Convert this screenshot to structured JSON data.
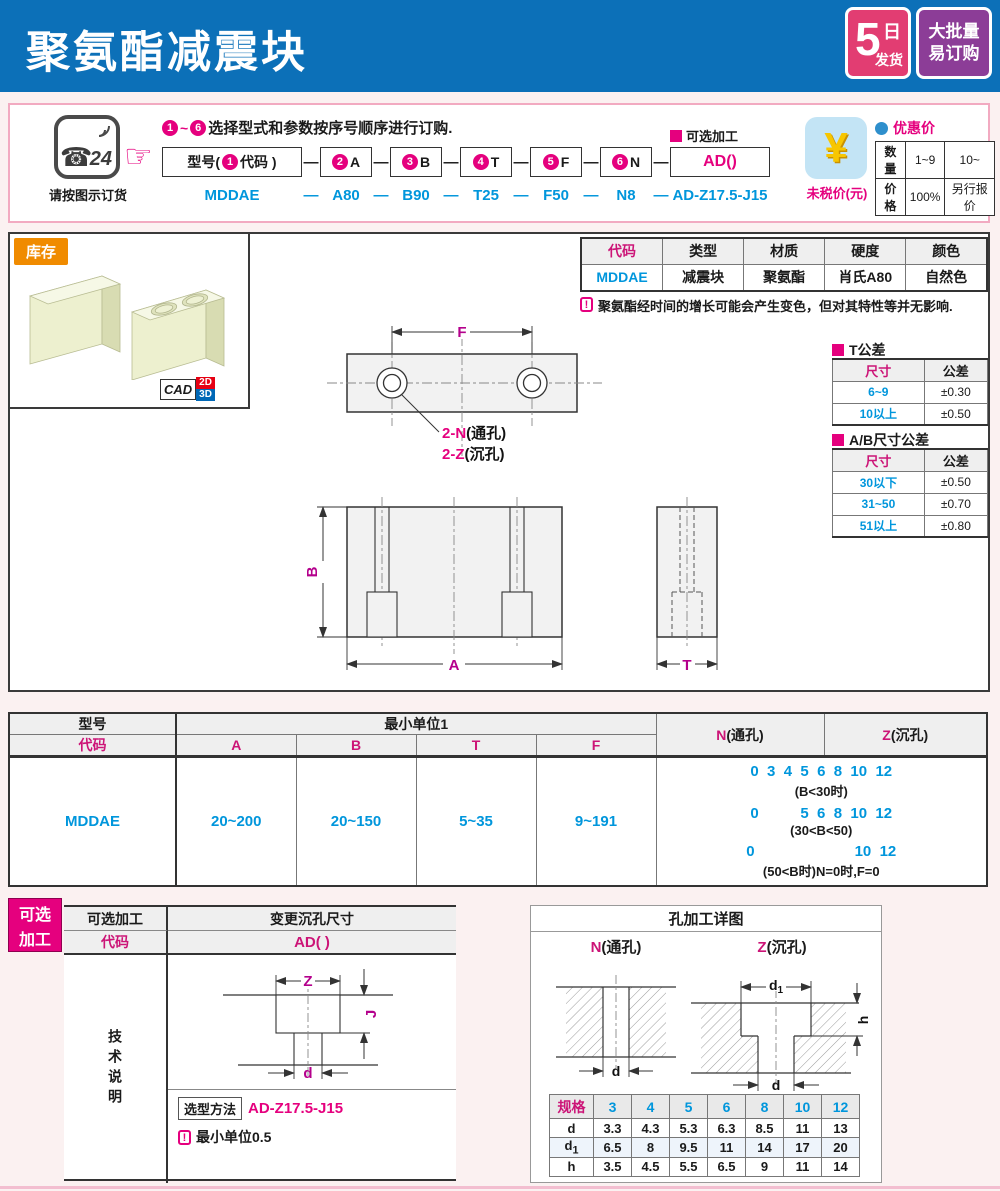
{
  "colors": {
    "header_blue": "#0c70b8",
    "accent_pink": "#e5007e",
    "data_blue": "#0096dc",
    "dim_magenta": "#b4008c",
    "stock_orange": "#f08b00",
    "badge_pink": "#e23d72",
    "badge_purple": "#8c3d97"
  },
  "chars": {
    "dash": "—",
    "tilde": "~"
  },
  "header": {
    "title": "聚氨酯减震块",
    "badge_days": {
      "num": "5",
      "unit": "日",
      "text": "发货"
    },
    "badge_bulk": {
      "line1": "大批量",
      "line2": "易订购"
    }
  },
  "order": {
    "phone": {
      "num": "24",
      "caption": "请按图示订货"
    },
    "instruction": {
      "start": "1",
      "end": "6",
      "text": "选择型式和参数按序号顺序进行订购."
    },
    "model_box": {
      "prefix": "型号(",
      "num": "1",
      "suffix": "代码 )"
    },
    "param_boxes": [
      {
        "num": "2",
        "label": "A"
      },
      {
        "num": "3",
        "label": "B"
      },
      {
        "num": "4",
        "label": "T"
      },
      {
        "num": "5",
        "label": "F"
      },
      {
        "num": "6",
        "label": "N"
      }
    ],
    "optional_label": "可选加工",
    "optional_box": "AD()",
    "example": {
      "model": "MDDAE",
      "a": "A80",
      "b": "B90",
      "t": "T25",
      "f": "F50",
      "n": "N8",
      "ad": "AD-Z17.5-J15"
    },
    "price": {
      "symbol": "¥",
      "untaxed": "未税价(元)",
      "discount": "优惠价",
      "qty_label": "数量",
      "qty1": "1~9",
      "qty2": "10~",
      "price_label": "价格",
      "p1": "100%",
      "p2": "另行报价"
    }
  },
  "stock": {
    "badge": "库存",
    "cad": "CAD",
    "d2": "2D",
    "d3": "3D"
  },
  "material_table": {
    "headers": [
      "代码",
      "类型",
      "材质",
      "硬度",
      "颜色"
    ],
    "row": [
      "MDDAE",
      "减震块",
      "聚氨酯",
      "肖氏A80",
      "自然色"
    ]
  },
  "note1": "聚氨酯经时间的增长可能会产生变色，但对其特性等并无影响.",
  "t_tol": {
    "title": "T公差",
    "h1": "尺寸",
    "h2": "公差",
    "rows": [
      [
        "6~9",
        "±0.30"
      ],
      [
        "10以上",
        "±0.50"
      ]
    ]
  },
  "ab_tol": {
    "title": "A/B尺寸公差",
    "h1": "尺寸",
    "h2": "公差",
    "rows": [
      [
        "30以下",
        "±0.50"
      ],
      [
        "31~50",
        "±0.70"
      ],
      [
        "51以上",
        "±0.80"
      ]
    ]
  },
  "drawing": {
    "f": "F",
    "a": "A",
    "b": "B",
    "t": "T",
    "hole_n_pink": "2-N",
    "hole_n_black": "(通孔)",
    "hole_z_pink": "2-Z",
    "hole_z_black": "(沉孔)"
  },
  "main_table": {
    "model": "型号",
    "code": "代码",
    "unit": "最小单位1",
    "cols": [
      "A",
      "B",
      "T",
      "F"
    ],
    "n_pink": "N",
    "n_black": "(通孔)",
    "z_pink": "Z",
    "z_black": "(沉孔)",
    "row": {
      "code": "MDDAE",
      "a": "20~200",
      "b": "20~150",
      "t": "5~35",
      "f": "9~191"
    },
    "nz": [
      {
        "nums": "0  3  4  5  6  8  10  12",
        "cond": "(B<30时)"
      },
      {
        "nums": "0          5  6  8  10  12",
        "cond": "(30<B<50)"
      },
      {
        "nums": "0                        10  12",
        "cond": "(50<B时)N=0时,F=0"
      }
    ]
  },
  "optional": {
    "badge1": "可选",
    "badge2": "加工",
    "h_left": "可选加工",
    "h_right": "变更沉孔尺寸",
    "code_label": "代码",
    "code_value": "AD( )",
    "tech": "技术说明",
    "dims": {
      "z": "Z",
      "j": "J",
      "d": "d"
    },
    "method_label": "选型方法",
    "method_value": "AD-Z17.5-J15",
    "note": "最小单位0.5"
  },
  "hole_detail": {
    "title": "孔加工详图",
    "n_pink": "N",
    "n_black": "(通孔)",
    "z_pink": "Z",
    "z_black": "(沉孔)",
    "dims": {
      "d": "d",
      "d1": "d",
      "d1sub": "1",
      "h": "h"
    },
    "spec": {
      "label": "规格",
      "sizes": [
        "3",
        "4",
        "5",
        "6",
        "8",
        "10",
        "12"
      ],
      "d": {
        "label": "d",
        "values": [
          "3.3",
          "4.3",
          "5.3",
          "6.3",
          "8.5",
          "11",
          "13"
        ]
      },
      "d1": {
        "label": "d",
        "sub": "1",
        "values": [
          "6.5",
          "8",
          "9.5",
          "11",
          "14",
          "17",
          "20"
        ]
      },
      "h": {
        "label": "h",
        "values": [
          "3.5",
          "4.5",
          "5.5",
          "6.5",
          "9",
          "11",
          "14"
        ]
      }
    }
  }
}
